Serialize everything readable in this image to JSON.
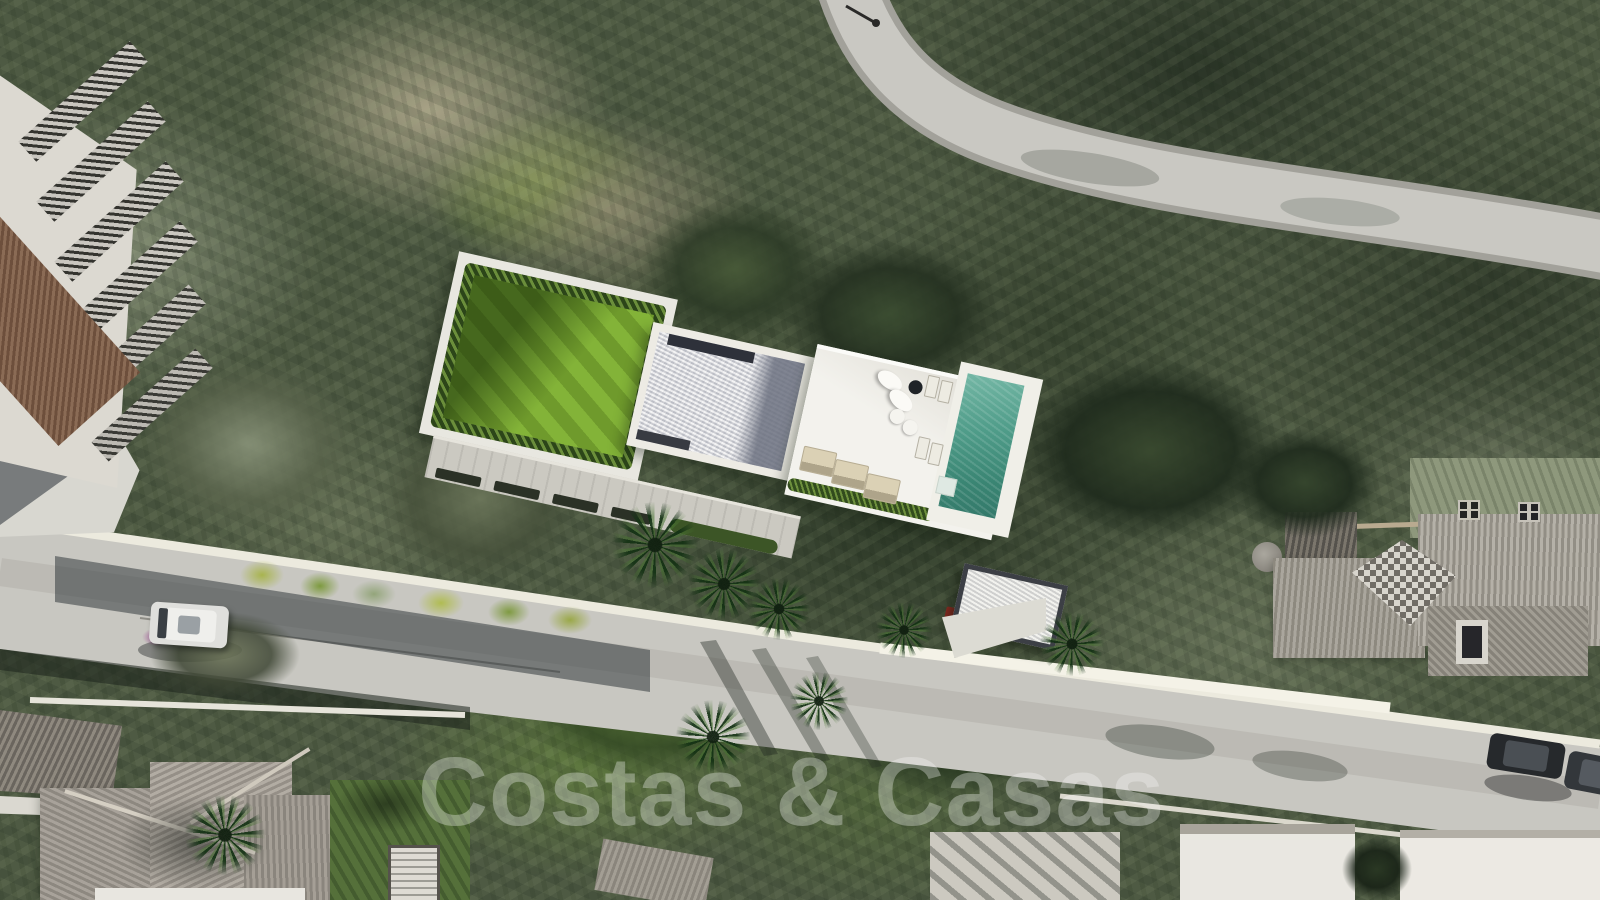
{
  "watermark": {
    "text": "Costas & Casas"
  },
  "scene": {
    "type": "aerial-drone-photo",
    "description": "Aerial view of a building plot with a rendered modern villa (lawn, gravel flat roof, white sun terrace, pool, carport) in a forested hillside, bordered by a curved upper road and a diagonal lower road with neighbouring tiled-roof houses",
    "villa": {
      "lawn": "green lawn bordered by hedge",
      "roof": "white gravel flat roof with dark inset",
      "terrace": "white sun terrace",
      "pool": "turquoise rectangular pool",
      "carport": "gravel-roof carport with cars beneath",
      "furniture": {
        "oval_daybeds": 2,
        "round_chairs": 2,
        "side_table": 1,
        "sun_loungers": 3,
        "pool_loungers": 4
      }
    },
    "roads": {
      "top_road": "curved hillside road with street lamp",
      "main_road": "diagonal road crossing lower half with white boundary walls"
    },
    "vehicles": {
      "white_car": 1,
      "dark_cars": 2
    },
    "houses": {
      "top_left": "apartment block with louvred pergola roofs and terracotta tiles",
      "bottom_left": "large villa with hipped tile roofs",
      "right": "villa complex with grey tile roofs, checkered roof face and chimney clusters",
      "bottom_right": "white houses"
    },
    "colors": {
      "forest_dark": "#33402e",
      "forest_olive": "#8a947c",
      "dirt": "#a8a186",
      "lawn": "#76a032",
      "pool": "#4f9c89",
      "terrace": "#f3f2ed",
      "road": "#c8c7c1",
      "tile_roof": "#948e85",
      "terracotta": "#8a6b55",
      "watermark_white": "#fafaf8"
    }
  }
}
